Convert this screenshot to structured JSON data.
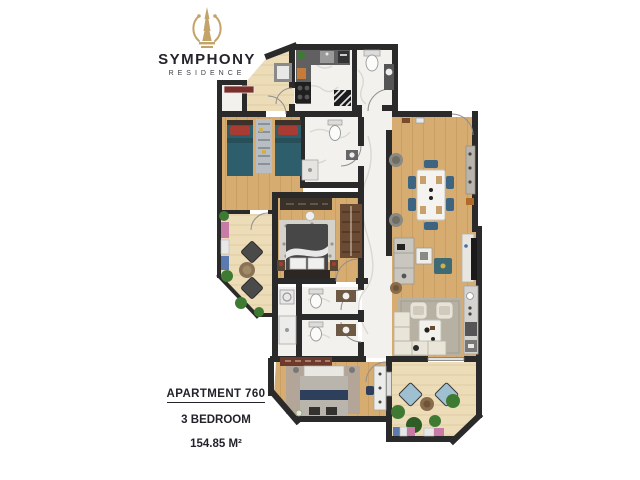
{
  "logo": {
    "title": "SYMPHONY",
    "subtitle": "RESIDENCE",
    "icon": "tower-lyre-icon"
  },
  "apartment": {
    "label": "APARTMENT 760",
    "bedrooms": "3 BEDROOM",
    "area": "154.85 M²"
  },
  "palette": {
    "brand_gold": "#c3a368",
    "text_dark": "#23232b",
    "wall": "#2a2a2a",
    "wood_floor": "#d7ac70",
    "wood_grain": "#c49a5e",
    "marble_floor": "#f2f1ee",
    "balcony_floor": "#ecdcb8",
    "balcony_grain": "#dcc79c",
    "accent_teal": "#2e5e6b",
    "accent_red": "#a93c32",
    "accent_blue": "#3d6480",
    "accent_navy": "#2e3f5c",
    "sofa_cream": "#e9e5d8",
    "rug_gray": "#b7b1a3",
    "closet_brown": "#6b4a33",
    "counter_gray": "#5f5f5f",
    "plant_green": "#3f7a33",
    "chair_lightblue": "#9fc0d0"
  },
  "rooms": [
    "vestibule",
    "kitchen",
    "bathroom-top",
    "storage",
    "twin-bedroom",
    "ensuite-bathroom",
    "hallway",
    "dining-area",
    "living-area",
    "master-bedroom",
    "laundry",
    "bathroom-1",
    "bathroom-2",
    "bedroom-3",
    "balcony-left",
    "balcony-rear",
    "entry"
  ]
}
